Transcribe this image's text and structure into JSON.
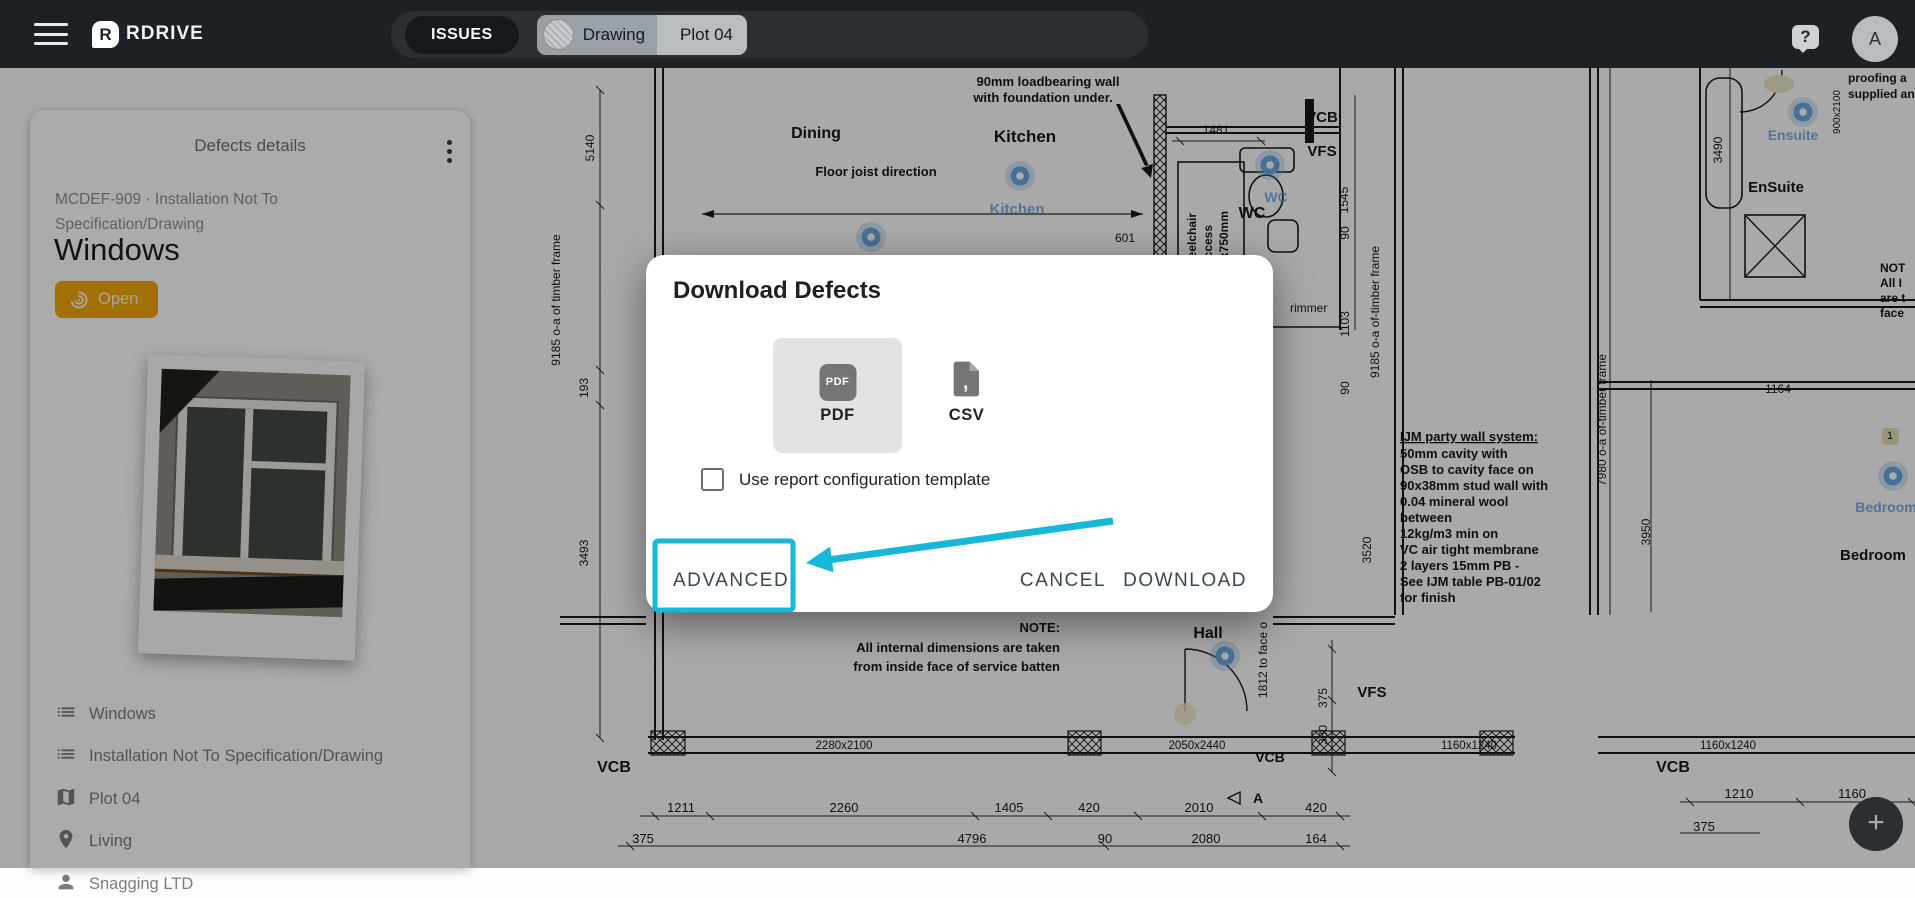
{
  "topbar": {
    "brand": "RDRIVE",
    "issues_label": "ISSUES",
    "context": {
      "drawing_label": "Drawing",
      "plot_label": "Plot 04"
    },
    "help_label": "?",
    "avatar_initial": "A"
  },
  "sidebar": {
    "title": "Defects details",
    "reference": "MCDEF-909 · Installation Not To Specification/Drawing",
    "heading": "Windows",
    "status": {
      "label": "Open",
      "color": "#f0a90a"
    },
    "items": [
      {
        "icon": "list-icon",
        "label": "Windows"
      },
      {
        "icon": "list-icon",
        "label": "Installation Not To Specification/Drawing"
      },
      {
        "icon": "map-icon",
        "label": "Plot 04"
      },
      {
        "icon": "pin-icon",
        "label": "Living"
      },
      {
        "icon": "company-icon",
        "label": "Snagging LTD"
      }
    ]
  },
  "modal": {
    "title": "Download Defects",
    "formats": [
      {
        "id": "pdf",
        "label": "PDF",
        "selected": true
      },
      {
        "id": "csv",
        "label": "CSV",
        "selected": false
      }
    ],
    "checkbox": {
      "checked": false,
      "label": "Use report configuration template"
    },
    "actions": {
      "advanced": "ADVANCED",
      "cancel": "CANCEL",
      "download": "DOWNLOAD"
    },
    "annotation_color": "#17b7d8"
  },
  "fab": {
    "label": "+"
  },
  "plan": {
    "ink": "#161616",
    "pin_color": "#6aa7e0",
    "pins": [
      {
        "x": 871,
        "y": 237
      },
      {
        "x": 1020,
        "y": 176
      },
      {
        "x": 1270,
        "y": 165
      },
      {
        "x": 1803,
        "y": 112
      },
      {
        "x": 1893,
        "y": 476
      },
      {
        "x": 1225,
        "y": 656
      }
    ],
    "labels": [
      {
        "t": "90mm loadbearing wall",
        "x": 1048,
        "y": 86,
        "s": 13,
        "b": 1
      },
      {
        "t": "with foundation under.",
        "x": 1043,
        "y": 102,
        "s": 13,
        "b": 1
      },
      {
        "t": "Dining",
        "x": 816,
        "y": 138,
        "s": 16,
        "b": 1
      },
      {
        "t": "Kitchen",
        "x": 1025,
        "y": 142,
        "s": 17,
        "b": 1
      },
      {
        "t": "Floor joist direction",
        "x": 876,
        "y": 176,
        "s": 13,
        "b": 1
      },
      {
        "t": "Kitchen",
        "x": 1017,
        "y": 214,
        "s": 15,
        "b": 1,
        "c": "blue"
      },
      {
        "t": "1481",
        "x": 1216,
        "y": 134,
        "s": 12
      },
      {
        "t": "601",
        "x": 1125,
        "y": 242,
        "s": 12
      },
      {
        "t": "WC",
        "x": 1252,
        "y": 218,
        "s": 16,
        "b": 1
      },
      {
        "t": "WC",
        "x": 1276,
        "y": 202,
        "s": 14,
        "b": 1,
        "c": "blue"
      },
      {
        "t": "VCB",
        "x": 1322,
        "y": 122,
        "s": 15,
        "b": 1
      },
      {
        "t": "VFS",
        "x": 1322,
        "y": 156,
        "s": 15,
        "b": 1
      },
      {
        "t": "Wheelchair",
        "x": 1196,
        "y": 245,
        "s": 12,
        "b": 1,
        "r": -90
      },
      {
        "t": "access",
        "x": 1212,
        "y": 245,
        "s": 12,
        "b": 1,
        "r": -90
      },
      {
        "t": "200x750mm",
        "x": 1228,
        "y": 245,
        "s": 12,
        "b": 1,
        "r": -90
      },
      {
        "t": "1545",
        "x": 1348,
        "y": 200,
        "s": 12,
        "r": -90
      },
      {
        "t": "5140",
        "x": 594,
        "y": 148,
        "s": 12,
        "r": -90
      },
      {
        "t": "9185 o-a of timber frame",
        "x": 560,
        "y": 300,
        "s": 12,
        "r": -90
      },
      {
        "t": "193",
        "x": 588,
        "y": 388,
        "s": 12,
        "r": -90
      },
      {
        "t": "3493",
        "x": 588,
        "y": 553,
        "s": 12,
        "r": -90
      },
      {
        "t": "90",
        "x": 1349,
        "y": 233,
        "s": 12,
        "r": -90
      },
      {
        "t": "1103",
        "x": 1349,
        "y": 324,
        "s": 12,
        "r": -90
      },
      {
        "t": "90",
        "x": 1349,
        "y": 388,
        "s": 12,
        "r": -90
      },
      {
        "t": "9185 o-a of-timber frame",
        "x": 1379,
        "y": 312,
        "s": 12,
        "r": -90
      },
      {
        "t": "3490",
        "x": 1722,
        "y": 150,
        "s": 12,
        "r": -90
      },
      {
        "t": "EnSuite",
        "x": 1776,
        "y": 192,
        "s": 15,
        "b": 1
      },
      {
        "t": "Ensuite",
        "x": 1793,
        "y": 140,
        "s": 14,
        "b": 1,
        "c": "blue"
      },
      {
        "t": "900x2100",
        "x": 1840,
        "y": 112,
        "s": 10,
        "r": -90
      },
      {
        "t": "proofing a",
        "x": 1848,
        "y": 82,
        "s": 12,
        "b": 1,
        "a": "s"
      },
      {
        "t": "supplied an",
        "x": 1848,
        "y": 98,
        "s": 12,
        "b": 1,
        "a": "s"
      },
      {
        "t": "NOT",
        "x": 1880,
        "y": 272,
        "s": 12,
        "b": 1,
        "a": "s"
      },
      {
        "t": "All I",
        "x": 1880,
        "y": 287,
        "s": 12,
        "b": 1,
        "a": "s"
      },
      {
        "t": "are t",
        "x": 1880,
        "y": 302,
        "s": 12,
        "b": 1,
        "a": "s"
      },
      {
        "t": "face",
        "x": 1880,
        "y": 317,
        "s": 12,
        "b": 1,
        "a": "s"
      },
      {
        "t": "rimmer",
        "x": 1290,
        "y": 312,
        "s": 12,
        "a": "s"
      },
      {
        "t": "1164",
        "x": 1778,
        "y": 393,
        "s": 12
      },
      {
        "t": "1",
        "x": 1890,
        "y": 439,
        "s": 11
      },
      {
        "t": "IJM party wall system:",
        "x": 1400,
        "y": 441,
        "s": 13,
        "b": 1,
        "a": "s",
        "u": 1
      },
      {
        "t": "50mm cavity with",
        "x": 1400,
        "y": 458,
        "s": 13,
        "b": 1,
        "a": "s"
      },
      {
        "t": "OSB to cavity face on",
        "x": 1400,
        "y": 474,
        "s": 13,
        "b": 1,
        "a": "s"
      },
      {
        "t": "90x38mm stud wall with",
        "x": 1400,
        "y": 490,
        "s": 13,
        "b": 1,
        "a": "s"
      },
      {
        "t": "0.04 mineral wool",
        "x": 1400,
        "y": 506,
        "s": 13,
        "b": 1,
        "a": "s"
      },
      {
        "t": "between",
        "x": 1400,
        "y": 522,
        "s": 13,
        "b": 1,
        "a": "s"
      },
      {
        "t": "12kg/m3 min on",
        "x": 1400,
        "y": 538,
        "s": 13,
        "b": 1,
        "a": "s"
      },
      {
        "t": "VC air tight membrane",
        "x": 1400,
        "y": 554,
        "s": 13,
        "b": 1,
        "a": "s"
      },
      {
        "t": "2 layers 15mm PB -",
        "x": 1400,
        "y": 570,
        "s": 13,
        "b": 1,
        "a": "s"
      },
      {
        "t": "See IJM table PB-01/02",
        "x": 1400,
        "y": 586,
        "s": 13,
        "b": 1,
        "a": "s"
      },
      {
        "t": "for finish",
        "x": 1400,
        "y": 602,
        "s": 13,
        "b": 1,
        "a": "s"
      },
      {
        "t": "7980 o-a of-timber frame",
        "x": 1606,
        "y": 420,
        "s": 12,
        "r": -90
      },
      {
        "t": "3950",
        "x": 1650,
        "y": 532,
        "s": 12,
        "r": -90
      },
      {
        "t": "3520",
        "x": 1371,
        "y": 550,
        "s": 12,
        "r": -90
      },
      {
        "t": "1812 to face o",
        "x": 1267,
        "y": 660,
        "s": 12,
        "r": -90
      },
      {
        "t": "375",
        "x": 1327,
        "y": 698,
        "s": 12,
        "r": -90
      },
      {
        "t": "380",
        "x": 1327,
        "y": 735,
        "s": 12,
        "r": -90
      },
      {
        "t": "Bedroom",
        "x": 1886,
        "y": 512,
        "s": 14,
        "b": 1,
        "c": "blue"
      },
      {
        "t": "Bedroom",
        "x": 1840,
        "y": 560,
        "s": 15,
        "b": 1,
        "a": "s"
      },
      {
        "t": "Hall",
        "x": 1208,
        "y": 638,
        "s": 16,
        "b": 1
      },
      {
        "t": "NOTE:",
        "x": 1060,
        "y": 632,
        "s": 13,
        "b": 1,
        "a": "e"
      },
      {
        "t": "All internal dimensions are taken",
        "x": 1060,
        "y": 652,
        "s": 13,
        "b": 1,
        "a": "e"
      },
      {
        "t": "from inside face of service batten",
        "x": 1060,
        "y": 671,
        "s": 13,
        "b": 1,
        "a": "e"
      },
      {
        "t": "VFS",
        "x": 1372,
        "y": 697,
        "s": 15,
        "b": 1
      },
      {
        "t": "2280x2100",
        "x": 844,
        "y": 749,
        "s": 11.5
      },
      {
        "t": "2050x2440",
        "x": 1197,
        "y": 749,
        "s": 11.5
      },
      {
        "t": "1160x1240",
        "x": 1469,
        "y": 749,
        "s": 11.5
      },
      {
        "t": "1160x1240",
        "x": 1728,
        "y": 749,
        "s": 11.5
      },
      {
        "t": "VCB",
        "x": 614,
        "y": 772,
        "s": 16,
        "b": 1
      },
      {
        "t": "VCB",
        "x": 1270,
        "y": 762,
        "s": 14,
        "b": 1
      },
      {
        "t": "VCB",
        "x": 1673,
        "y": 772,
        "s": 16,
        "b": 1
      },
      {
        "t": "1211",
        "x": 681,
        "y": 812,
        "s": 13
      },
      {
        "t": "2260",
        "x": 844,
        "y": 812,
        "s": 13
      },
      {
        "t": "1405",
        "x": 1009,
        "y": 812,
        "s": 13
      },
      {
        "t": "420",
        "x": 1089,
        "y": 812,
        "s": 13
      },
      {
        "t": "2010",
        "x": 1199,
        "y": 812,
        "s": 13
      },
      {
        "t": "A",
        "x": 1258,
        "y": 803,
        "s": 14,
        "b": 1
      },
      {
        "t": "420",
        "x": 1316,
        "y": 812,
        "s": 13
      },
      {
        "t": "375",
        "x": 643,
        "y": 843,
        "s": 13
      },
      {
        "t": "4796",
        "x": 972,
        "y": 843,
        "s": 13
      },
      {
        "t": "90",
        "x": 1105,
        "y": 843,
        "s": 13
      },
      {
        "t": "2080",
        "x": 1206,
        "y": 843,
        "s": 13
      },
      {
        "t": "164",
        "x": 1316,
        "y": 843,
        "s": 13
      },
      {
        "t": "1210",
        "x": 1739,
        "y": 798,
        "s": 13
      },
      {
        "t": "1160",
        "x": 1852,
        "y": 798,
        "s": 13
      },
      {
        "t": "375",
        "x": 1704,
        "y": 831,
        "s": 13
      }
    ]
  }
}
